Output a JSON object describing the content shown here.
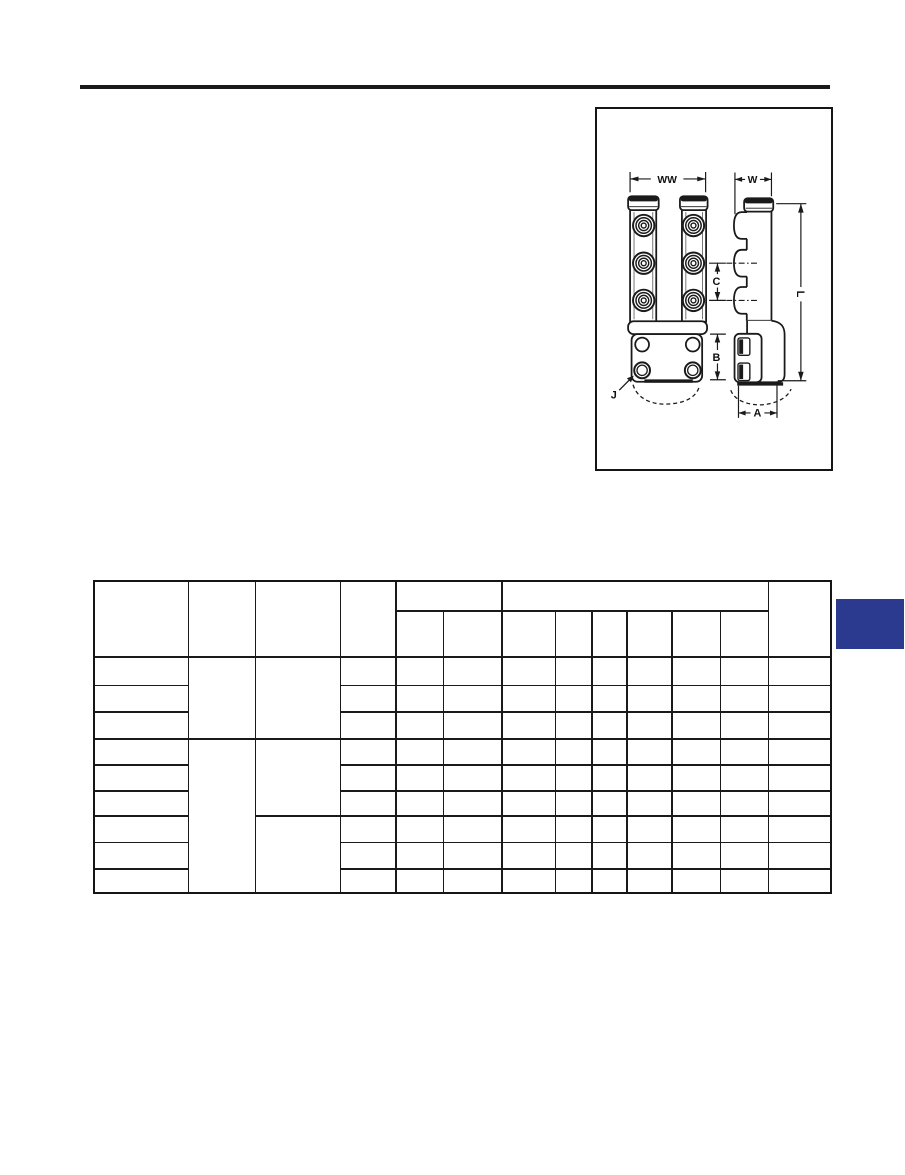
{
  "diagram": {
    "dimension_labels": {
      "ww": "WW",
      "w": "W",
      "c": "C",
      "l": "L",
      "b": "B",
      "j": "J",
      "a": "A"
    }
  },
  "table": {
    "columns": 13,
    "body_rows": 9,
    "header_group_columns": 8
  },
  "colors": {
    "ink": "#1a1a1a",
    "page_tab_blue": "#2b3a8e"
  }
}
